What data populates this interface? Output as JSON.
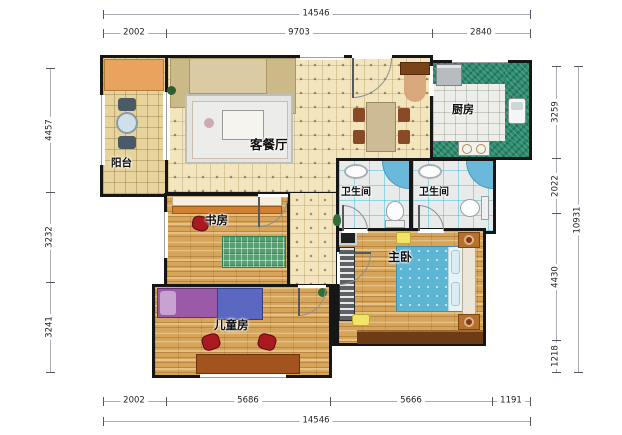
{
  "plan": {
    "type": "apartment-floor-plan",
    "rooms": {
      "living": {
        "label": "客餐厅"
      },
      "kitchen": {
        "label": "厨房"
      },
      "bath1": {
        "label": "卫生间"
      },
      "bath2": {
        "label": "卫生间"
      },
      "master": {
        "label": "主卧"
      },
      "study": {
        "label": "书房"
      },
      "kids": {
        "label": "儿童房"
      },
      "balcony": {
        "label": "阳台"
      }
    },
    "dimensions": {
      "top": {
        "total": "14546",
        "segments": [
          "2002",
          "9703",
          "2840"
        ]
      },
      "bottom": {
        "total": "14546",
        "segments": [
          "2002",
          "5686",
          "5666",
          "1191"
        ]
      },
      "left": {
        "segments": [
          "4457",
          "3232",
          "3241"
        ]
      },
      "right": {
        "total": "10931",
        "segments": [
          "3259",
          "2022",
          "4430",
          "1218"
        ]
      }
    },
    "colors": {
      "wall": "#161616",
      "floor_tile": "#f3e5bd",
      "balcony_tile": "#e6d49c",
      "wood_floor": "#d7a55a",
      "kitchen_counter": "#2d8c70",
      "shower_blue": "#6ab8da",
      "bed_blue": "#5cb6d3",
      "kids_bed_purple": "#9a5aa8",
      "accent_red": "#a81a20",
      "dresser_brown": "#6e3c14"
    }
  }
}
